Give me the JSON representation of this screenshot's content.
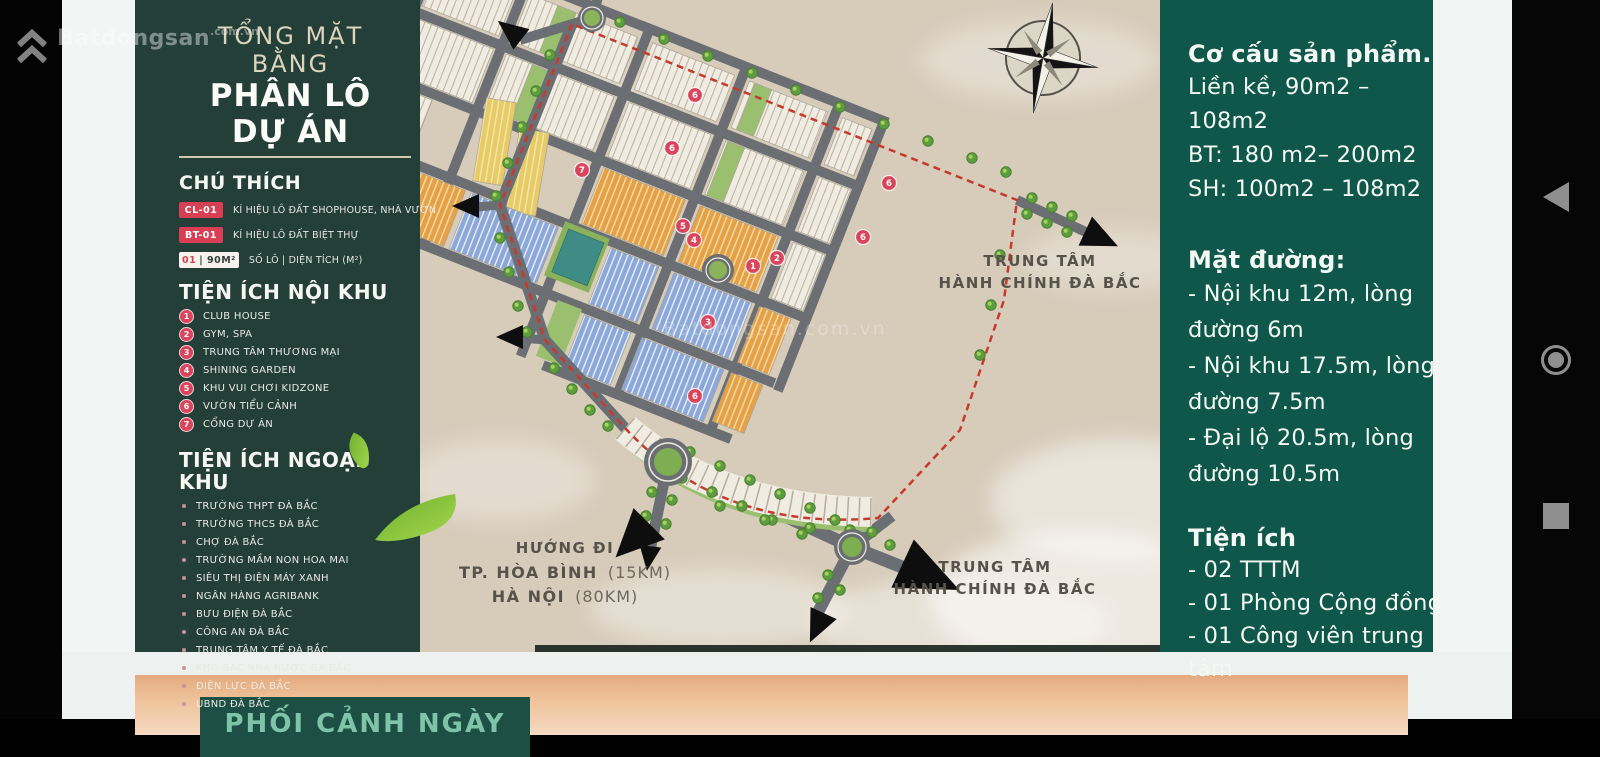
{
  "watermark": {
    "brand": "Batdongsan",
    "suffix": ".com.vn"
  },
  "left_panel": {
    "title_line1": "TỔNG MẶT BẰNG",
    "title_line2": "PHÂN LÔ DỰ ÁN",
    "legend_title": "CHÚ THÍCH",
    "legend": [
      {
        "badge": "CL-01",
        "style": "red",
        "label": "KÍ HIỆU LÔ ĐẤT SHOPHOUSE, NHÀ VƯỜN"
      },
      {
        "badge": "BT-01",
        "style": "red",
        "label": "KÍ HIỆU LÔ ĐẤT BIỆT THỰ"
      },
      {
        "badge": "01",
        "badge2": "| 90M²",
        "style": "white",
        "label": "SỐ LÔ  |  DIỆN TÍCH (M²)"
      }
    ],
    "section1_title": "TIỆN ÍCH NỘI KHU",
    "section1_items": [
      {
        "num": "1",
        "label": "CLUB HOUSE"
      },
      {
        "num": "2",
        "label": "GYM, SPA"
      },
      {
        "num": "3",
        "label": "TRUNG TÂM THƯƠNG MẠI"
      },
      {
        "num": "4",
        "label": "SHINING GARDEN"
      },
      {
        "num": "5",
        "label": "KHU VUI CHƠI KIDZONE"
      },
      {
        "num": "6",
        "label": "VƯỜN TIỂU CẢNH"
      },
      {
        "num": "7",
        "label": "CỔNG DỰ ÁN"
      }
    ],
    "section2_title": "TIỆN ÍCH NGOẠI KHU",
    "section2_items": [
      "TRƯỜNG THPT ĐÀ BẮC",
      "TRƯỜNG THCS ĐÀ BẮC",
      "CHỢ ĐÀ BẮC",
      "TRƯỜNG MẦM NON HOA MAI",
      "SIÊU THỊ ĐIỆN MÁY XANH",
      "NGÂN HÀNG AGRIBANK",
      "BƯU ĐIỆN ĐÀ BẮC",
      "CÔNG AN ĐÀ BẮC",
      "TRUNG TÂM Y TẾ ĐÀ BẮC",
      "KHO BẠC NHÀ NƯỚC ĐÀ BẮC",
      "ĐIỆN LỰC ĐÀ BẮC",
      "UBND ĐÀ BẮC"
    ]
  },
  "map": {
    "labels": {
      "admin1": "TRUNG TÂM",
      "admin2": "HÀNH CHÍNH ĐÀ BẮC"
    },
    "direction": {
      "line1": "HƯỚNG ĐI",
      "line2": "TP. HÒA BÌNH",
      "line2_note": "(15KM)",
      "line3": "HÀ NỘI",
      "line3_note": "(80KM)"
    },
    "markers": [
      {
        "n": "1",
        "x": 333,
        "y": 266
      },
      {
        "n": "2",
        "x": 357,
        "y": 258
      },
      {
        "n": "3",
        "x": 288,
        "y": 322
      },
      {
        "n": "4",
        "x": 274,
        "y": 240
      },
      {
        "n": "5",
        "x": 263,
        "y": 226
      },
      {
        "n": "6",
        "x": 275,
        "y": 95
      },
      {
        "n": "6",
        "x": 252,
        "y": 148
      },
      {
        "n": "6",
        "x": 469,
        "y": 183
      },
      {
        "n": "6",
        "x": 443,
        "y": 237
      },
      {
        "n": "6",
        "x": 275,
        "y": 396
      },
      {
        "n": "7",
        "x": 162,
        "y": 170
      }
    ],
    "watermark": "Batdongsan.com.vn"
  },
  "right_panel": {
    "blocks": [
      {
        "title": "Cơ cấu sản phẩm.",
        "lines": [
          "Liền kề, 90m2 – 108m2",
          "BT: 180 m2– 200m2",
          "SH: 100m2 – 108m2"
        ]
      },
      {
        "title": "Mặt đường:",
        "lines": [
          "- Nội khu 12m, lòng đường 6m",
          "- Nội khu 17.5m, lòng đường 7.5m",
          "- Đại lộ 20.5m, lòng đường 10.5m"
        ]
      },
      {
        "title": "Tiện ích",
        "lines": [
          "- 02 TTTM",
          "- 01 Phòng Cộng đồng",
          "- 01 Công viên trung tâm"
        ]
      }
    ]
  },
  "bottom_section": {
    "caption": "PHỐI CẢNH NGÀY"
  },
  "colors": {
    "panel_left": "#233f38",
    "panel_right": "#0f574a",
    "accent_red": "#d8455c",
    "map_bg": "#d7ccba",
    "road": "#6b6f73",
    "boundary_red": "#c63a2e",
    "lot_blue": "#8ca8d8",
    "lot_orange": "#e4a147",
    "lot_yellow": "#e7cb66"
  }
}
